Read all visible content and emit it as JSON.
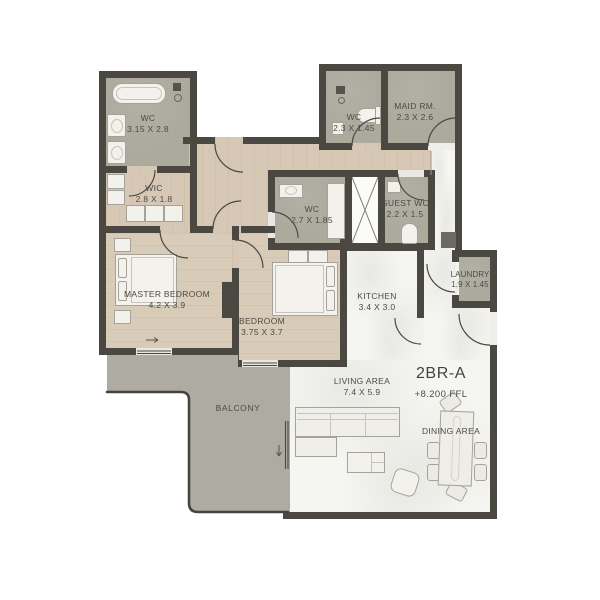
{
  "plan": {
    "unit": {
      "label": "2BR-A",
      "ffl": "+8.200 FFL"
    },
    "rooms": {
      "wc_master": {
        "name": "WC",
        "dims": "3.15 X 2.8"
      },
      "wic": {
        "name": "WIC",
        "dims": "2.8 X 1.8"
      },
      "master": {
        "name": "MASTER BEDROOM",
        "dims": "4.2 X 3.9"
      },
      "bedroom": {
        "name": "BEDROOM",
        "dims": "3.75 X 3.7"
      },
      "wc_shared": {
        "name": "WC",
        "dims": "2.7 X 1.85"
      },
      "wc_small": {
        "name": "WC",
        "dims": "2.3 X 1.45"
      },
      "maid": {
        "name": "MAID RM.",
        "dims": "2.3 X 2.6"
      },
      "guest_wc": {
        "name": "GUEST WC",
        "dims": "2.2 X 1.5"
      },
      "laundry": {
        "name": "LAUNDRY",
        "dims": "1.9 X 1.45"
      },
      "kitchen": {
        "name": "KITCHEN",
        "dims": "3.4 X 3.0"
      },
      "living": {
        "name": "LIVING AREA",
        "dims": "7.4 X 5.9"
      },
      "dining": {
        "name": "DINING AREA"
      },
      "balcony": {
        "name": "BALCONY"
      }
    },
    "colors": {
      "wall": "#4b4842",
      "wood_floor": "#d6c8b4",
      "bathroom_floor": "#abaa9d",
      "balcony_floor": "#adaba2",
      "living_floor": "#f5f5f2",
      "text": "#4d4b46"
    }
  }
}
